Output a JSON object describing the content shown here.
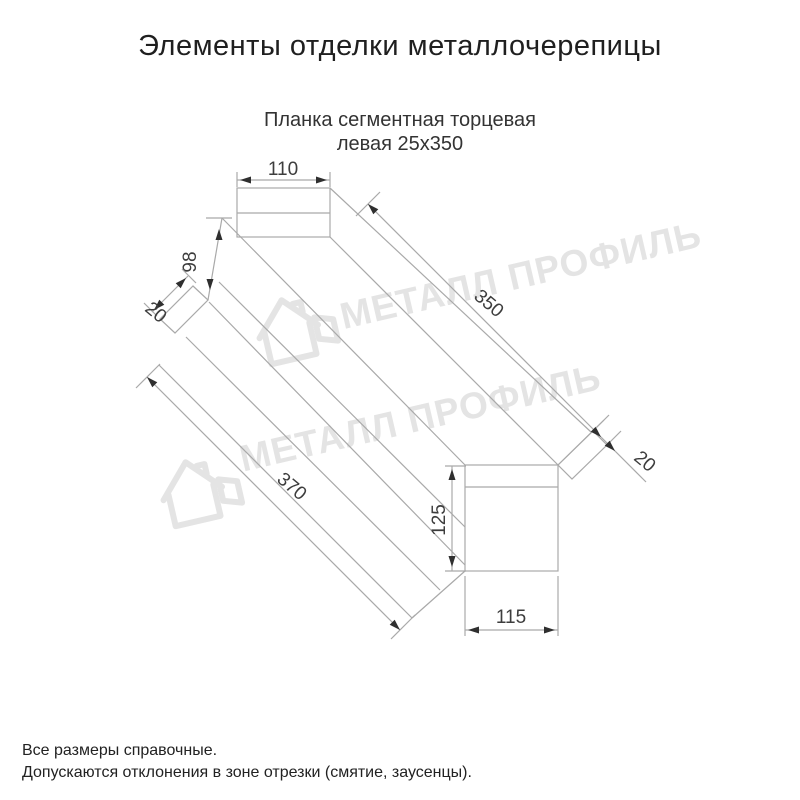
{
  "title": "Элементы отделки металлочерепицы",
  "subtitle": {
    "line1": "Планка сегментная торцевая",
    "line2": "левая 25х350"
  },
  "watermark": {
    "text": "МЕТАЛЛ ПРОФИЛЬ",
    "color": "#e4e4e4"
  },
  "drawing": {
    "dims": {
      "top_width": "110",
      "back_height": "98",
      "near_tab": "20",
      "top_edge_length": "350",
      "bottom_edge_length": "370",
      "face_height": "125",
      "far_tab": "20",
      "bottom_width": "115"
    }
  },
  "notes": {
    "line1": "Все размеры справочные.",
    "line2": "Допускаются отклонения в зоне отрезки (смятие, заусенцы)."
  },
  "colors": {
    "line": "#a9a9a9",
    "dim_text": "#3d3d3d",
    "title_text": "#1f1f1f"
  }
}
